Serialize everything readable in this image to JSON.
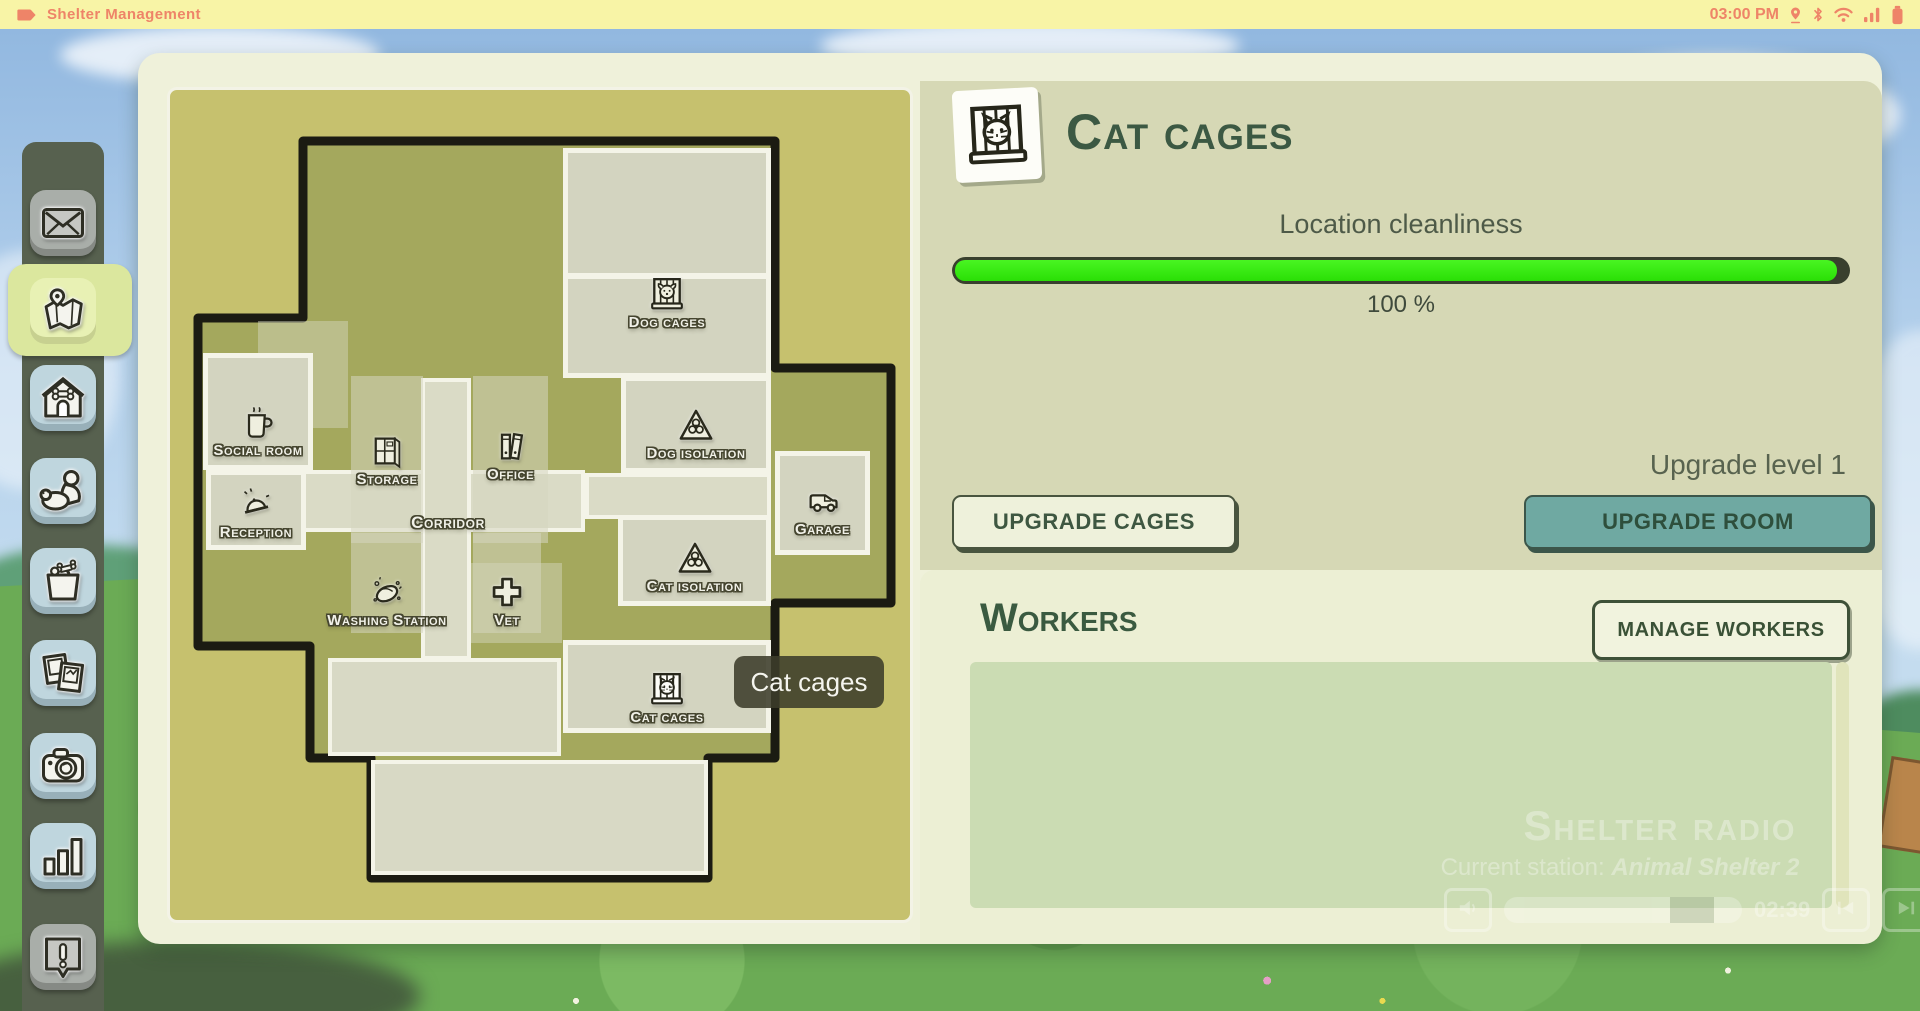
{
  "status_bar": {
    "app_title": "Shelter Management",
    "time": "03:00 PM",
    "icons": [
      "tag-icon",
      "location-icon",
      "bluetooth-icon",
      "wifi-icon",
      "signal-icon",
      "battery-icon"
    ]
  },
  "sidebar": {
    "items": [
      {
        "id": "mail",
        "icon": "envelope-icon",
        "style": "gray",
        "active": false
      },
      {
        "id": "map",
        "icon": "map-icon",
        "style": "blue",
        "active": true
      },
      {
        "id": "shelter",
        "icon": "doghouse-icon",
        "style": "blue",
        "active": false
      },
      {
        "id": "animals",
        "icon": "person-dog-icon",
        "style": "blue",
        "active": false
      },
      {
        "id": "supplies",
        "icon": "shopping-bag-icon",
        "style": "blue",
        "active": false
      },
      {
        "id": "photos",
        "icon": "photos-icon",
        "style": "blue",
        "active": false
      },
      {
        "id": "camera",
        "icon": "camera-icon",
        "style": "blue",
        "active": false
      },
      {
        "id": "stats",
        "icon": "bar-chart-icon",
        "style": "blue",
        "active": false
      },
      {
        "id": "alerts",
        "icon": "alert-icon",
        "style": "gray",
        "active": false
      }
    ]
  },
  "map": {
    "tooltip": "Cat cages",
    "rooms": [
      {
        "id": "dog-cages",
        "label": "Dog cages",
        "icon": "cage-dog-icon"
      },
      {
        "id": "social-room",
        "label": "Social room",
        "icon": "mug-icon"
      },
      {
        "id": "storage",
        "label": "Storage",
        "icon": "shelf-icon"
      },
      {
        "id": "office",
        "label": "Office",
        "icon": "binders-icon"
      },
      {
        "id": "dog-isolation",
        "label": "Dog isolation",
        "icon": "biohazard-icon"
      },
      {
        "id": "reception",
        "label": "Reception",
        "icon": "bell-icon"
      },
      {
        "id": "corridor",
        "label": "Corridor",
        "icon": null
      },
      {
        "id": "washing-station",
        "label": "Washing Station",
        "icon": "sponge-icon"
      },
      {
        "id": "vet",
        "label": "Vet",
        "icon": "cross-icon"
      },
      {
        "id": "cat-isolation",
        "label": "Cat isolation",
        "icon": "biohazard-icon"
      },
      {
        "id": "garage",
        "label": "Garage",
        "icon": "van-icon"
      },
      {
        "id": "cat-cages",
        "label": "Cat cages",
        "icon": "cage-cat-icon"
      }
    ]
  },
  "room_panel": {
    "title": "Cat cages",
    "title_icon": "cage-cat-icon",
    "cleanliness_label": "Location cleanliness",
    "cleanliness_value": "100 %",
    "cleanliness_pct": 100,
    "upgrade_level": "Upgrade level 1",
    "upgrade_cages_button": "UPGRADE CAGES",
    "upgrade_room_button": "UPGRADE ROOM"
  },
  "workers": {
    "title": "Workers",
    "manage_button": "MANAGE WORKERS",
    "list": []
  },
  "radio": {
    "title": "Shelter radio",
    "station_prefix": "Current station:",
    "station_name": "Animal Shelter 2",
    "elapsed": "02:39"
  },
  "colors": {
    "statusbar_bg": "#F8F4A6",
    "statusbar_text": "#EE8468",
    "panel_cream": "#EFF1DA",
    "info_beige": "#D6D8B5",
    "map_khaki": "#C6C16E",
    "building_olive": "#A4A85D",
    "progress_green": "#2ADF06",
    "accent_teal": "#6FA9A2",
    "title_green": "#3C5943",
    "sidebar_bg": "#57614F",
    "active_highlight": "#DBE79E"
  }
}
